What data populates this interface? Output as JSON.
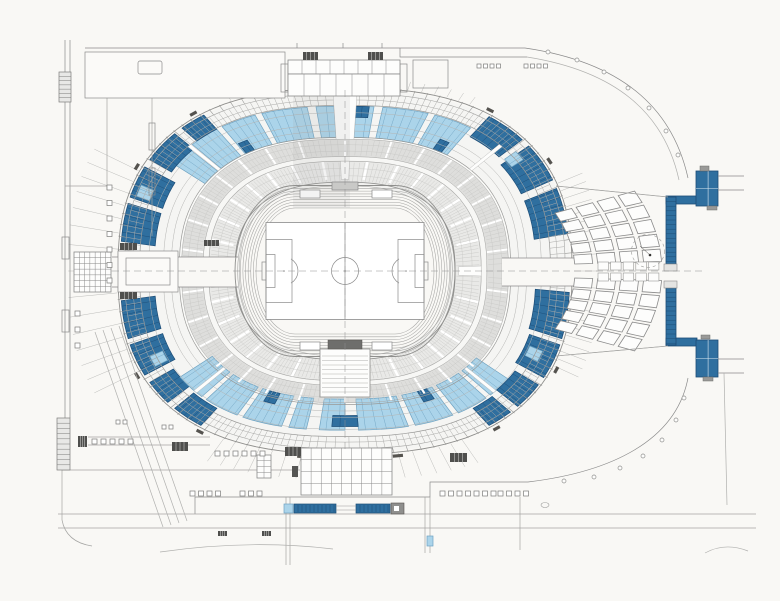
{
  "meta": {
    "title": "Stadium site plan — level plan with athletics track, soccer pitch, tiered seating bowl with blue seating sections, east wing of rooms and surrounding plaza walls"
  },
  "canvas": {
    "w": 780,
    "h": 601,
    "bg": "#f9f8f5"
  },
  "palette": {
    "dark_blue": "#2f6f9f",
    "dark_blue_stroke": "#1d4d77",
    "light_blue": "#abd4ea",
    "light_blue_stroke": "#6fa3c2",
    "line": "#8a8a8a",
    "line_light": "#bcbcba",
    "paper": "#f9f8f5",
    "tier_low": "#e9e9e7",
    "tier_up": "#dededc",
    "hatch_dark": "#4f4f4d",
    "white": "#ffffff",
    "mid_gray": "#9a9a9a"
  },
  "bowl": {
    "cx": 345,
    "cy": 271,
    "rx": 227,
    "ry": 183,
    "p": 0.8,
    "fills": [
      [
        0.465,
        0.485,
        "#f2f2f0"
      ],
      [
        0.485,
        0.6,
        "#e9e9e7"
      ],
      [
        0.6,
        0.625,
        "#f7f7f5"
      ],
      [
        0.625,
        0.72,
        "#dededc"
      ],
      [
        0.72,
        0.73,
        "#fafaf8"
      ],
      [
        0.73,
        0.99,
        "#f5f5f3"
      ]
    ],
    "rings": [
      [
        1.0,
        "#8f8f8d",
        0.9
      ],
      [
        0.97,
        "#a5a5a3",
        0.6
      ],
      [
        0.935,
        "#aaaaa8",
        0.5
      ],
      [
        0.905,
        "#9a9a98",
        0.7
      ],
      [
        0.865,
        "#b4b4b2",
        0.5
      ],
      [
        0.8,
        "#b4b4b2",
        0.5
      ],
      [
        0.765,
        "#b4b4b2",
        0.5
      ],
      [
        0.73,
        "#9a9a98",
        0.7
      ],
      [
        0.72,
        "#a5a5a3",
        0.5
      ],
      [
        0.69,
        "#c6c6c4",
        0.4
      ],
      [
        0.655,
        "#c6c6c4",
        0.4
      ],
      [
        0.625,
        "#a5a5a3",
        0.5
      ],
      [
        0.6,
        "#a5a5a3",
        0.6
      ],
      [
        0.56,
        "#c6c6c4",
        0.4
      ],
      [
        0.52,
        "#c6c6c4",
        0.4
      ],
      [
        0.485,
        "#8f8f8d",
        0.8
      ],
      [
        0.465,
        "#b0b0ae",
        0.6
      ]
    ],
    "ticks": [
      [
        0,
        360,
        3.2,
        0.97,
        1.005,
        "#9a9a98",
        0.6
      ],
      [
        0,
        360,
        1.6,
        0.905,
        0.968,
        "#ababa9",
        0.5
      ],
      [
        -26,
        26,
        2.6,
        1.005,
        1.12,
        "#bcbcba",
        0.5
      ],
      [
        152,
        208,
        4,
        1.005,
        1.22,
        "#bcbcba",
        0.5
      ],
      [
        243,
        297,
        3.3,
        1.005,
        1.14,
        "#bcbcba",
        0.5
      ],
      [
        62,
        118,
        3.3,
        1.005,
        1.05,
        "#bcbcba",
        0.5
      ],
      [
        0,
        360,
        1.6,
        0.49,
        0.592,
        "#c9c9c7",
        0.45
      ],
      [
        0,
        360,
        1.6,
        0.632,
        0.715,
        "#c9c9c7",
        0.45
      ],
      [
        0,
        360,
        12,
        0.5,
        0.6,
        "#ffffff",
        2.4
      ],
      [
        6,
        360,
        12,
        0.628,
        0.72,
        "#ffffff",
        2
      ]
    ],
    "segments": [
      [
        8,
        22,
        0.84,
        0.99,
        "d"
      ],
      [
        25,
        39,
        0.84,
        0.99,
        "d"
      ],
      [
        42,
        55,
        0.86,
        0.99,
        "d"
      ],
      [
        57,
        69,
        0.73,
        0.9,
        "l"
      ],
      [
        71,
        83,
        0.73,
        0.9,
        "l"
      ],
      [
        85,
        88.5,
        0.73,
        0.9,
        "l"
      ],
      [
        91.5,
        95,
        0.73,
        0.9,
        "l"
      ],
      [
        97,
        109,
        0.73,
        0.9,
        "l"
      ],
      [
        111,
        122,
        0.73,
        0.9,
        "l"
      ],
      [
        124,
        134,
        0.73,
        0.9,
        "l"
      ],
      [
        136,
        144,
        0.73,
        0.9,
        "l"
      ],
      [
        59.5,
        63,
        0.73,
        0.79,
        "d"
      ],
      [
        86,
        90,
        0.84,
        0.9,
        "d"
      ],
      [
        118,
        121.5,
        0.73,
        0.79,
        "d"
      ],
      [
        124,
        132,
        0.9,
        0.99,
        "d"
      ],
      [
        135,
        147,
        0.88,
        0.99,
        "d"
      ],
      [
        150,
        161,
        0.84,
        0.99,
        "d"
      ],
      [
        163,
        174,
        0.84,
        0.99,
        "d"
      ],
      [
        186,
        197,
        0.84,
        0.99,
        "d"
      ],
      [
        199,
        210,
        0.84,
        0.99,
        "d"
      ],
      [
        213,
        222,
        0.87,
        0.99,
        "d"
      ],
      [
        225,
        235,
        0.88,
        0.99,
        "d"
      ],
      [
        217,
        228,
        0.7,
        0.87,
        "l"
      ],
      [
        230,
        242,
        0.7,
        0.87,
        "l"
      ],
      [
        244,
        256,
        0.7,
        0.87,
        "l"
      ],
      [
        258,
        262.5,
        0.7,
        0.87,
        "l"
      ],
      [
        265.5,
        270,
        0.7,
        0.87,
        "l"
      ],
      [
        272,
        284,
        0.7,
        0.87,
        "l"
      ],
      [
        286,
        298,
        0.7,
        0.87,
        "l"
      ],
      [
        300,
        311,
        0.7,
        0.87,
        "l"
      ],
      [
        313,
        322,
        0.7,
        0.87,
        "l"
      ],
      [
        247,
        251,
        0.7,
        0.76,
        "d"
      ],
      [
        268,
        272,
        0.79,
        0.85,
        "d"
      ],
      [
        292,
        296,
        0.7,
        0.76,
        "d"
      ],
      [
        305,
        313,
        0.88,
        0.99,
        "d"
      ],
      [
        316,
        326,
        0.87,
        0.99,
        "d"
      ],
      [
        329,
        341,
        0.85,
        0.99,
        "d"
      ],
      [
        343,
        356,
        0.84,
        0.99,
        "d"
      ],
      [
        36,
        40,
        0.87,
        0.93,
        "l"
      ],
      [
        205,
        209,
        0.87,
        0.93,
        "l"
      ],
      [
        333,
        337,
        0.87,
        0.93,
        "l"
      ],
      [
        156,
        160,
        0.905,
        0.965,
        "l"
      ]
    ],
    "wedges": [
      [
        90,
        3,
        0.72,
        1.005
      ],
      [
        90,
        1.6,
        0.5,
        0.6
      ],
      [
        270,
        1.6,
        0.5,
        0.6
      ],
      [
        45,
        1.4,
        0.73,
        0.905
      ],
      [
        135,
        1.4,
        0.73,
        0.905
      ],
      [
        225,
        1.4,
        0.7,
        0.87
      ],
      [
        315,
        1.4,
        0.7,
        0.87
      ],
      [
        0,
        2.4,
        0.5,
        0.6
      ],
      [
        180,
        2.4,
        0.5,
        0.6
      ]
    ],
    "stubs": [
      30,
      55,
      95,
      125,
      150,
      208,
      235,
      262,
      278,
      305,
      332
    ]
  },
  "channels": [
    [
      112,
      257,
      126,
      30
    ],
    [
      502,
      258,
      72,
      28
    ]
  ],
  "track": {
    "cx": 345,
    "cy": 271,
    "lanes": 9,
    "w0": 110,
    "h0": 85.5,
    "dw": 2.625,
    "dh": 2.8125,
    "straight": 50,
    "marks": [
      [
        300,
        190,
        20,
        8
      ],
      [
        372,
        190,
        20,
        8
      ],
      [
        300,
        342,
        20,
        8
      ],
      [
        372,
        342,
        20,
        8
      ]
    ]
  },
  "field": {
    "x": 266,
    "y": 222.5,
    "w": 158,
    "h": 97,
    "circle_r": 13.5,
    "pen_d": 26,
    "pen_h": 63,
    "goal_d": 9,
    "goal_h": 33,
    "spots": [
      [
        284,
        271
      ],
      [
        406,
        271
      ]
    ],
    "goals": [
      [
        262,
        262,
        4,
        18
      ],
      [
        424,
        262,
        4,
        18
      ]
    ],
    "arcs": [
      "M291,258.9 A14,14 0 0 1 291,283.1",
      "M399,258.9 A14,14 0 0 0 399,283.1"
    ]
  },
  "tunnel": {
    "box": [
      320,
      349,
      50,
      48
    ],
    "cap": [
      328,
      340,
      34,
      9
    ],
    "x0": 322,
    "x1": 368,
    "y0": 356,
    "y1": 394,
    "dy": 4.5
  },
  "east_wing": {
    "cx": 345,
    "cy": 271,
    "ky": 0.62,
    "rows": [
      [
        230,
        248
      ],
      [
        253,
        271
      ],
      [
        276,
        294
      ],
      [
        299,
        317
      ]
    ],
    "cols": [
      4.6,
      9,
      13.4,
      17.8,
      22.2
    ],
    "halfw": 1.8,
    "center_rooms": {
      "x0": 598,
      "dx": 12.6,
      "cols": 5,
      "w": 10.5,
      "rows_y": [
        262,
        273
      ],
      "h": 8
    },
    "circle": {
      "x": 648,
      "y": 251,
      "r": 16.5,
      "dot": [
        650,
        255
      ],
      "needle": "M650,255 L640,246"
    },
    "bounds": [
      "M556,186 L668,197",
      "M556,356 L668,346"
    ]
  },
  "corridor": {
    "segs": [
      [
        666,
        197,
        10,
        67
      ],
      [
        666,
        288,
        10,
        57
      ]
    ],
    "hbars": [
      [
        666,
        196,
        31,
        8
      ],
      [
        666,
        338,
        31,
        8
      ]
    ],
    "blocks": [
      [
        696,
        171,
        22,
        35
      ],
      [
        696,
        340,
        22,
        37
      ]
    ],
    "tabs": [
      [
        700,
        166,
        9,
        5
      ],
      [
        707,
        206,
        10,
        4
      ],
      [
        701,
        335,
        9,
        4
      ],
      [
        703,
        377,
        10,
        4
      ]
    ],
    "connectors": [
      [
        664,
        264,
        13,
        7
      ],
      [
        664,
        281,
        13,
        7
      ]
    ],
    "cell_step": 4.6
  },
  "south_strip": {
    "lightsq": [
      284,
      504,
      9,
      9
    ],
    "segs": [
      [
        294,
        504,
        42,
        9
      ],
      [
        356,
        504,
        34,
        9
      ]
    ],
    "cap": [
      391,
      503,
      13,
      11
    ],
    "gap_lines": [
      "M336,506 H356",
      "M336,510 H356"
    ],
    "tick_step": 4
  },
  "walls": [
    {
      "d": "M85,48 H525"
    },
    {
      "d": "M400,48 V57 H527"
    },
    {
      "d": "M525,48 C620,62 672,106 688,178"
    },
    {
      "d": "M527,57 C615,71 664,112 679,180",
      "c": "#b0b0ae"
    },
    {
      "d": "M718,176 H744"
    },
    {
      "d": "M718,190 H744"
    },
    {
      "d": "M718,359 H744"
    },
    {
      "d": "M718,373 H744"
    },
    {
      "d": "M724,373 L727,505",
      "c": "#b0b0ae"
    },
    {
      "d": "M688,378 C676,441 611,472 528,482"
    },
    {
      "d": "M528,482 H430 V497 H195 V514"
    },
    {
      "d": "M58,514 H756",
      "c": "#a5a5a3"
    },
    {
      "d": "M58,528 H756",
      "c": "#a5a5a3"
    },
    {
      "d": "M65,40 V418"
    },
    {
      "d": "M70,40 V418"
    },
    {
      "d": "M62,418 V520",
      "c": "#a5a5a3"
    },
    {
      "d": "M62,520 Q66,542 92,546",
      "c": "#a5a5a3"
    },
    {
      "d": "M85,58 H285"
    },
    {
      "d": "M107,98 V190",
      "c": "#a5a5a3"
    },
    {
      "d": "M65,186 H107",
      "c": "#a5a5a3"
    },
    {
      "d": "M152,98 V236",
      "c": "#a5a5a3"
    },
    {
      "d": "M95,332 L163,527",
      "c": "#b0b0ae"
    },
    {
      "d": "M103,330 L171,525",
      "c": "#b0b0ae"
    },
    {
      "d": "M111,328 L179,523",
      "c": "#b0b0ae"
    },
    {
      "d": "M119,326 L187,521",
      "c": "#b0b0ae"
    },
    {
      "d": "M286,497 V565",
      "c": "#a5a5a3"
    },
    {
      "d": "M290,497 V565",
      "c": "#a5a5a3"
    },
    {
      "d": "M425,497 V553",
      "c": "#a5a5a3"
    },
    {
      "d": "M430,497 V553",
      "c": "#a5a5a3"
    },
    {
      "d": "M520,497 V550",
      "c": "#a5a5a3"
    },
    {
      "d": "M160,552 Q250,539 333,549",
      "c": "#b0b0ae"
    },
    {
      "d": "M705,553 Q725,542 748,551",
      "c": "#b0b0ae"
    },
    {
      "d": "M62,470 H300",
      "c": "#a5a5a3"
    },
    {
      "d": "M88,437 H210",
      "c": "#a5a5a3"
    },
    {
      "d": "M88,445 H210",
      "c": "#a5a5a3"
    },
    {
      "d": "M112,257 H238"
    },
    {
      "d": "M112,287 H238"
    },
    {
      "d": "M502,258 H574"
    },
    {
      "d": "M502,286 H574"
    },
    {
      "d": "M556,186 L668,197",
      "c": "#a5a5a3"
    },
    {
      "d": "M556,356 L668,346",
      "c": "#a5a5a3"
    },
    {
      "d": "M297,43 V48"
    },
    {
      "d": "M343,43 V48"
    },
    {
      "d": "M382,43 V48"
    }
  ],
  "rects": [
    {
      "x": 85,
      "y": 52,
      "w": 200,
      "h": 46,
      "f": "#fbfaf8"
    },
    {
      "x": 138,
      "y": 61,
      "w": 24,
      "h": 13,
      "rx": 2
    },
    {
      "x": 281,
      "y": 64,
      "w": 7,
      "h": 28
    },
    {
      "x": 400,
      "y": 64,
      "w": 7,
      "h": 28
    },
    {
      "x": 413,
      "y": 60,
      "w": 35,
      "h": 28
    },
    {
      "x": 118,
      "y": 251,
      "w": 60,
      "h": 41,
      "f": "#fbfaf8"
    },
    {
      "x": 126,
      "y": 258,
      "w": 44,
      "h": 27
    },
    {
      "x": 149,
      "y": 123,
      "w": 6,
      "h": 27
    },
    {
      "x": 149,
      "y": 168,
      "w": 6,
      "h": 27
    },
    {
      "x": 62,
      "y": 237,
      "w": 7,
      "h": 22
    },
    {
      "x": 62,
      "y": 310,
      "w": 7,
      "h": 22
    },
    {
      "x": 292,
      "y": 466,
      "w": 6,
      "h": 11,
      "f": "#555553",
      "s": "none"
    },
    {
      "x": 427,
      "y": 536,
      "w": 6,
      "h": 10,
      "f": "#abd4ea",
      "s": "#6fa3c2"
    },
    {
      "x": 332,
      "y": 182,
      "w": 26,
      "h": 8,
      "f": "#c9c9c7"
    }
  ],
  "grids": [
    {
      "x": 288,
      "y": 60,
      "w": 112,
      "h": 14,
      "cols": 8,
      "rows": 1
    },
    {
      "x": 288,
      "y": 74,
      "w": 112,
      "h": 22,
      "cols": 7,
      "rows": 1
    },
    {
      "x": 74,
      "y": 252,
      "w": 37,
      "h": 40,
      "cols": 7,
      "rows": 7
    },
    {
      "x": 301,
      "y": 448,
      "w": 91,
      "h": 47,
      "cols": 9,
      "rows": 4
    },
    {
      "x": 257,
      "y": 455,
      "w": 14,
      "h": 23,
      "cols": 2,
      "rows": 4
    }
  ],
  "square_rows": [
    [
      477,
      64,
      4,
      4,
      2.5,
      "h"
    ],
    [
      524,
      64,
      4,
      4,
      2.5,
      "h"
    ],
    [
      92,
      439,
      5,
      5,
      4,
      "h"
    ],
    [
      215,
      451,
      6,
      5,
      4,
      "h"
    ],
    [
      116,
      420,
      2,
      4,
      3,
      "h"
    ],
    [
      162,
      425,
      2,
      4,
      3,
      "h"
    ],
    [
      190,
      491,
      4,
      5,
      3.5,
      "h"
    ],
    [
      240,
      491,
      3,
      5,
      3.5,
      "h"
    ],
    [
      440,
      491,
      7,
      5,
      3.5,
      "h"
    ],
    [
      498,
      491,
      4,
      5,
      3.5,
      "h"
    ],
    [
      107,
      185,
      7,
      5,
      10.5,
      "v"
    ],
    [
      75,
      311,
      3,
      5,
      11,
      "v"
    ]
  ],
  "hatches": [
    [
      303,
      52,
      15,
      8
    ],
    [
      368,
      52,
      15,
      8
    ],
    [
      120,
      243,
      17,
      7
    ],
    [
      120,
      292,
      17,
      7
    ],
    [
      204,
      240,
      15,
      6
    ],
    [
      78,
      436,
      9,
      11
    ],
    [
      172,
      442,
      16,
      9
    ],
    [
      285,
      447,
      16,
      9
    ],
    [
      450,
      453,
      17,
      9
    ],
    [
      218,
      531,
      9,
      5
    ],
    [
      262,
      531,
      9,
      5
    ]
  ],
  "ladders": [
    [
      59,
      72,
      12,
      30,
      6
    ],
    [
      57,
      418,
      13,
      52,
      9
    ]
  ],
  "dots": [
    [
      548,
      52
    ],
    [
      577,
      60
    ],
    [
      604,
      72
    ],
    [
      628,
      88
    ],
    [
      649,
      108
    ],
    [
      666,
      131
    ],
    [
      678,
      155
    ],
    [
      684,
      398
    ],
    [
      676,
      420
    ],
    [
      662,
      440
    ],
    [
      643,
      456
    ],
    [
      620,
      468
    ],
    [
      594,
      477
    ],
    [
      564,
      481
    ]
  ],
  "ellipses": [
    [
      545,
      505,
      4,
      2.5
    ]
  ],
  "shade": [
    293,
    96,
    57,
    112
  ],
  "dashes": [
    {
      "d": "M112,271 H702"
    },
    {
      "d": "M345,90 V452"
    }
  ]
}
